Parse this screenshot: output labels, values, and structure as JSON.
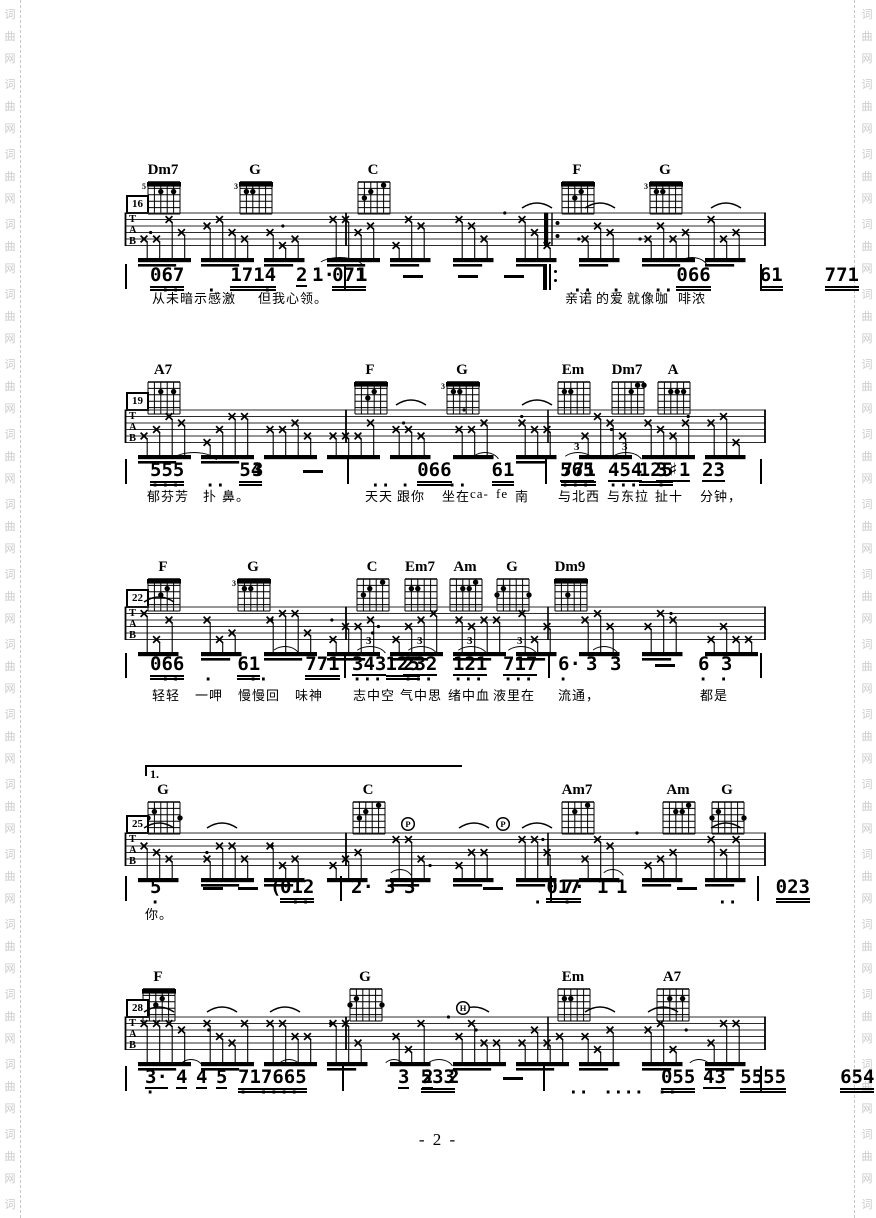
{
  "page": {
    "number": "- 2 -",
    "watermark": "词曲网",
    "clef_letters": [
      "T",
      "A",
      "B"
    ],
    "ink_color": "#000000",
    "watermark_color": "#c9c9c9",
    "background": "#ffffff"
  },
  "systems": [
    {
      "measure": "16",
      "top": 162,
      "staff_top": 213,
      "melody_y": 266,
      "lyrics_y": 288,
      "repeat_x": 548,
      "chords": [
        {
          "name": "Dm7",
          "x": 148,
          "fret": "5",
          "barre": true,
          "dots": [
            [
              3,
              2
            ],
            [
              5,
              2
            ]
          ]
        },
        {
          "name": "G",
          "x": 240,
          "fret": "3",
          "barre": true,
          "dots": [
            [
              2,
              2
            ],
            [
              3,
              2
            ]
          ]
        },
        {
          "name": "C",
          "x": 358,
          "fret": "",
          "barre": false,
          "dots": [
            [
              2,
              3
            ],
            [
              3,
              2
            ],
            [
              5,
              1
            ]
          ]
        },
        {
          "name": "F",
          "x": 562,
          "fret": "",
          "barre": true,
          "dots": [
            [
              3,
              3
            ],
            [
              4,
              2
            ]
          ]
        },
        {
          "name": "G",
          "x": 650,
          "fret": "3",
          "barre": true,
          "dots": [
            [
              2,
              2
            ],
            [
              3,
              2
            ]
          ]
        }
      ],
      "melody": [
        {
          "t": "|",
          "x": 125,
          "bar": true
        },
        {
          "t": "067",
          "x": 150,
          "u": 2,
          "d": " ··"
        },
        {
          "t": "1714",
          "x": 196,
          "u": 2,
          "d": " ·"
        },
        {
          "t": "071",
          "x": 252,
          "u": 2,
          "d": " ·"
        },
        {
          "t": "2",
          "x": 296,
          "u": 1
        },
        {
          "t": "1·",
          "x": 312
        },
        {
          "t": "|",
          "x": 344,
          "bar": true
        },
        {
          "t": "1",
          "x": 356
        },
        {
          "t": "—",
          "x": 403
        },
        {
          "t": "—",
          "x": 458
        },
        {
          "t": "—",
          "x": 504
        },
        {
          "t": "‖:",
          "x": 543,
          "rep": true
        },
        {
          "t": "066",
          "x": 562,
          "u": 2,
          "d": " ··"
        },
        {
          "t": "61",
          "x": 611,
          "u": 2,
          "d": "·"
        },
        {
          "t": "771",
          "x": 653,
          "u": 2,
          "d": "··"
        },
        {
          "t": "125",
          "x": 698,
          "u": 2
        },
        {
          "t": "|",
          "x": 760,
          "bar": true
        }
      ],
      "arcs": [
        {
          "x1": 316,
          "x2": 362
        },
        {
          "x1": 676,
          "x2": 706
        }
      ],
      "lyrics": [
        {
          "t": "从未暗示感激",
          "x": 152
        },
        {
          "t": "但我心领。",
          "x": 258
        },
        {
          "t": "亲诺",
          "x": 565
        },
        {
          "t": "的爱",
          "x": 596
        },
        {
          "t": "就像咖",
          "x": 627
        },
        {
          "t": "啡浓",
          "x": 678
        }
      ],
      "ann": []
    },
    {
      "measure": "19",
      "top": 362,
      "staff_top": 410,
      "melody_y": 461,
      "lyrics_y": 486,
      "chords": [
        {
          "name": "A7",
          "x": 148,
          "fret": "",
          "barre": false,
          "dots": [
            [
              3,
              2
            ],
            [
              5,
              2
            ]
          ]
        },
        {
          "name": "F",
          "x": 355,
          "fret": "",
          "barre": true,
          "dots": [
            [
              3,
              3
            ],
            [
              4,
              2
            ]
          ]
        },
        {
          "name": "G",
          "x": 447,
          "fret": "3",
          "barre": true,
          "dots": [
            [
              2,
              2
            ],
            [
              3,
              2
            ]
          ]
        },
        {
          "name": "Em",
          "x": 558,
          "fret": "",
          "barre": false,
          "dots": [
            [
              2,
              2
            ],
            [
              3,
              2
            ]
          ]
        },
        {
          "name": "Dm7",
          "x": 612,
          "fret": "",
          "barre": false,
          "dots": [
            [
              4,
              2
            ],
            [
              5,
              1
            ],
            [
              6,
              1
            ]
          ]
        },
        {
          "name": "A",
          "x": 658,
          "fret": "",
          "barre": false,
          "dots": [
            [
              3,
              2
            ],
            [
              4,
              2
            ],
            [
              5,
              2
            ]
          ]
        }
      ],
      "melody": [
        {
          "t": "|",
          "x": 125,
          "bar": true
        },
        {
          "t": "555",
          "x": 150,
          "u": 2,
          "d": "···"
        },
        {
          "t": "54",
          "x": 205,
          "u": 2,
          "d": "··"
        },
        {
          "t": "3",
          "x": 252
        },
        {
          "t": "—",
          "x": 303
        },
        {
          "t": "|",
          "x": 347,
          "bar": true
        },
        {
          "t": "066",
          "x": 360,
          "u": 2,
          "d": " ··"
        },
        {
          "t": "61",
          "x": 400,
          "u": 2,
          "d": "·"
        },
        {
          "t": "771",
          "x": 447,
          "u": 2,
          "d": "··"
        },
        {
          "t": "125",
          "x": 490,
          "u": 2
        },
        {
          "t": "|",
          "x": 545,
          "bar": true
        },
        {
          "t": "565",
          "x": 560,
          "u": 1,
          "d": "···"
        },
        {
          "t": "454",
          "x": 608,
          "u": 1,
          "d": "···"
        },
        {
          "t": "3♯1",
          "x": 656,
          "u": 1,
          "d": "·"
        },
        {
          "t": "23",
          "x": 702,
          "u": 1
        },
        {
          "t": "|",
          "x": 760,
          "bar": true
        }
      ],
      "arcs": [
        {
          "x1": 170,
          "x2": 216
        },
        {
          "x1": 470,
          "x2": 498
        },
        {
          "x1": 561,
          "x2": 593,
          "n": "3"
        },
        {
          "x1": 609,
          "x2": 641,
          "n": "3"
        }
      ],
      "lyrics": [
        {
          "t": "郁芬芳",
          "x": 147
        },
        {
          "t": "扑",
          "x": 203
        },
        {
          "t": "鼻。",
          "x": 222
        },
        {
          "t": "天天",
          "x": 365
        },
        {
          "t": "跟你",
          "x": 397
        },
        {
          "t": "坐在",
          "x": 442
        },
        {
          "t": "ca-",
          "x": 470
        },
        {
          "t": "fe",
          "x": 496
        },
        {
          "t": "南",
          "x": 515
        },
        {
          "t": "与北西",
          "x": 558
        },
        {
          "t": "与东拉",
          "x": 607
        },
        {
          "t": "扯十",
          "x": 655
        },
        {
          "t": "分钟，",
          "x": 700
        }
      ],
      "ann": []
    },
    {
      "measure": "22",
      "top": 559,
      "staff_top": 607,
      "melody_y": 655,
      "lyrics_y": 685,
      "chords": [
        {
          "name": "F",
          "x": 148,
          "fret": "",
          "barre": true,
          "dots": [
            [
              3,
              3
            ],
            [
              4,
              2
            ]
          ]
        },
        {
          "name": "G",
          "x": 238,
          "fret": "3",
          "barre": true,
          "dots": [
            [
              2,
              2
            ],
            [
              3,
              2
            ]
          ]
        },
        {
          "name": "C",
          "x": 357,
          "fret": "",
          "barre": false,
          "dots": [
            [
              2,
              3
            ],
            [
              3,
              2
            ],
            [
              5,
              1
            ]
          ]
        },
        {
          "name": "Em7",
          "x": 405,
          "fret": "",
          "barre": false,
          "dots": [
            [
              2,
              2
            ],
            [
              3,
              2
            ]
          ]
        },
        {
          "name": "Am",
          "x": 450,
          "fret": "",
          "barre": false,
          "dots": [
            [
              5,
              1
            ],
            [
              3,
              2
            ],
            [
              4,
              2
            ]
          ]
        },
        {
          "name": "G",
          "x": 497,
          "fret": "",
          "barre": false,
          "dots": [
            [
              1,
              3
            ],
            [
              2,
              2
            ],
            [
              6,
              3
            ]
          ]
        },
        {
          "name": "Dm9",
          "x": 555,
          "fret": "",
          "barre": true,
          "dots": [
            [
              3,
              3
            ]
          ]
        }
      ],
      "melody": [
        {
          "t": "|",
          "x": 125,
          "bar": true
        },
        {
          "t": "066",
          "x": 150,
          "u": 2,
          "d": " ··"
        },
        {
          "t": "61",
          "x": 203,
          "u": 2,
          "d": "·"
        },
        {
          "t": "771",
          "x": 248,
          "u": 2,
          "d": "··"
        },
        {
          "t": "125",
          "x": 294,
          "u": 2
        },
        {
          "t": "|",
          "x": 344,
          "bar": true
        },
        {
          "t": "343",
          "x": 352,
          "u": 1,
          "d": "···"
        },
        {
          "t": "232",
          "x": 403,
          "u": 1,
          "d": "···"
        },
        {
          "t": "121",
          "x": 453,
          "u": 1,
          "d": "···"
        },
        {
          "t": "717",
          "x": 503,
          "u": 1,
          "d": "···"
        },
        {
          "t": "|",
          "x": 548,
          "bar": true
        },
        {
          "t": "6·",
          "x": 558,
          "d": "·"
        },
        {
          "t": "3",
          "x": 586
        },
        {
          "t": "3",
          "x": 610
        },
        {
          "t": "—",
          "x": 655
        },
        {
          "t": "6 3",
          "x": 698,
          "d": "· ·"
        },
        {
          "t": "|",
          "x": 760,
          "bar": true
        }
      ],
      "arcs": [
        {
          "x1": 270,
          "x2": 298
        },
        {
          "x1": 353,
          "x2": 385,
          "n": "3"
        },
        {
          "x1": 404,
          "x2": 436,
          "n": "3"
        },
        {
          "x1": 454,
          "x2": 486,
          "n": "3"
        },
        {
          "x1": 504,
          "x2": 536,
          "n": "3"
        },
        {
          "x1": 589,
          "x2": 617
        }
      ],
      "lyrics": [
        {
          "t": "轻轻",
          "x": 152
        },
        {
          "t": "一呷",
          "x": 195
        },
        {
          "t": "慢慢回",
          "x": 238
        },
        {
          "t": "味神",
          "x": 295
        },
        {
          "t": "志中空",
          "x": 353
        },
        {
          "t": "气中思",
          "x": 400
        },
        {
          "t": "绪中血",
          "x": 448
        },
        {
          "t": "液里在",
          "x": 493
        },
        {
          "t": "流通，",
          "x": 558
        },
        {
          "t": "都是",
          "x": 700
        }
      ],
      "ann": []
    },
    {
      "measure": "25",
      "top": 782,
      "staff_top": 833,
      "melody_y": 878,
      "lyrics_y": 904,
      "volta": {
        "label": "1.",
        "x": 145,
        "y": 765,
        "w": 315
      },
      "chords": [
        {
          "name": "G",
          "x": 148,
          "fret": "",
          "barre": false,
          "dots": [
            [
              1,
              3
            ],
            [
              2,
              2
            ],
            [
              6,
              3
            ]
          ]
        },
        {
          "name": "C",
          "x": 353,
          "fret": "",
          "barre": false,
          "dots": [
            [
              2,
              3
            ],
            [
              3,
              2
            ],
            [
              5,
              1
            ]
          ]
        },
        {
          "name": "Am7",
          "x": 562,
          "fret": "",
          "barre": false,
          "dots": [
            [
              3,
              2
            ],
            [
              5,
              1
            ]
          ]
        },
        {
          "name": "Am",
          "x": 663,
          "fret": "",
          "barre": false,
          "dots": [
            [
              5,
              1
            ],
            [
              3,
              2
            ],
            [
              4,
              2
            ]
          ]
        },
        {
          "name": "G",
          "x": 712,
          "fret": "",
          "barre": false,
          "dots": [
            [
              1,
              3
            ],
            [
              2,
              2
            ],
            [
              6,
              3
            ]
          ]
        }
      ],
      "melody": [
        {
          "t": "|",
          "x": 125,
          "bar": true
        },
        {
          "t": "5",
          "x": 150,
          "d": "·"
        },
        {
          "t": "—",
          "x": 203
        },
        {
          "t": "—",
          "x": 238
        },
        {
          "t": "(",
          "x": 270
        },
        {
          "t": "012",
          "x": 280,
          "u": 2,
          "d": " ··"
        },
        {
          "t": "|",
          "x": 340,
          "bar": true
        },
        {
          "t": "2·",
          "x": 351
        },
        {
          "t": "3",
          "x": 384
        },
        {
          "t": "3",
          "x": 404
        },
        {
          "t": "—",
          "x": 483
        },
        {
          "t": "017",
          "x": 512,
          "u": 2,
          "d": "  ·"
        },
        {
          "t": "|",
          "x": 550,
          "bar": true
        },
        {
          "t": "7·",
          "x": 562,
          "d": "·"
        },
        {
          "t": "1",
          "x": 597
        },
        {
          "t": "1",
          "x": 616
        },
        {
          "t": "—",
          "x": 677
        },
        {
          "t": "023",
          "x": 707,
          "u": 2,
          "d": " ··"
        },
        {
          "t": "|",
          "x": 757,
          "bar": true
        }
      ],
      "arcs": [
        {
          "x1": 387,
          "x2": 411
        },
        {
          "x1": 600,
          "x2": 623
        }
      ],
      "lyrics": [
        {
          "t": "你。",
          "x": 145
        }
      ],
      "ann": [
        {
          "t": "P",
          "x": 408
        },
        {
          "t": "P",
          "x": 503
        }
      ]
    },
    {
      "measure": "28",
      "top": 969,
      "staff_top": 1017,
      "melody_y": 1068,
      "lyrics_y": null,
      "chords": [
        {
          "name": "F",
          "x": 143,
          "fret": "",
          "barre": true,
          "dots": [
            [
              3,
              3
            ],
            [
              4,
              2
            ]
          ]
        },
        {
          "name": "G",
          "x": 350,
          "fret": "",
          "barre": false,
          "dots": [
            [
              1,
              3
            ],
            [
              2,
              2
            ],
            [
              6,
              3
            ]
          ]
        },
        {
          "name": "Em",
          "x": 558,
          "fret": "",
          "barre": false,
          "dots": [
            [
              2,
              2
            ],
            [
              3,
              2
            ]
          ]
        },
        {
          "name": "A7",
          "x": 657,
          "fret": "",
          "barre": false,
          "dots": [
            [
              3,
              2
            ],
            [
              5,
              2
            ]
          ]
        }
      ],
      "melody": [
        {
          "t": "|",
          "x": 125,
          "bar": true
        },
        {
          "t": "3·",
          "x": 145,
          "u": 1,
          "d": "·"
        },
        {
          "t": "4",
          "x": 176,
          "u": 1
        },
        {
          "t": "4",
          "x": 196,
          "u": 1
        },
        {
          "t": "5",
          "x": 216,
          "u": 1
        },
        {
          "t": "717665",
          "x": 238,
          "u": 2,
          "d": "· ····"
        },
        {
          "t": "|",
          "x": 342,
          "bar": true
        },
        {
          "t": "533",
          "x": 352,
          "u": 2
        },
        {
          "t": "3",
          "x": 398,
          "u": 1
        },
        {
          "t": "2",
          "x": 422,
          "u": 1
        },
        {
          "t": "2",
          "x": 448
        },
        {
          "t": "—",
          "x": 503
        },
        {
          "t": "|",
          "x": 543,
          "bar": true
        },
        {
          "t": "055",
          "x": 558,
          "u": 2,
          "d": " ··"
        },
        {
          "t": "5555",
          "x": 603,
          "u": 2,
          "d": "····"
        },
        {
          "t": "654",
          "x": 657,
          "u": 2,
          "d": "··"
        },
        {
          "t": "43",
          "x": 703,
          "u": 1
        },
        {
          "t": "|",
          "x": 760,
          "bar": true
        }
      ],
      "arcs": [
        {
          "x1": 178,
          "x2": 202
        },
        {
          "x1": 276,
          "x2": 300
        },
        {
          "x1": 382,
          "x2": 404
        },
        {
          "x1": 424,
          "x2": 452
        },
        {
          "x1": 686,
          "x2": 710
        }
      ],
      "lyrics": [],
      "ann": [
        {
          "t": "H",
          "x": 463
        }
      ]
    }
  ]
}
